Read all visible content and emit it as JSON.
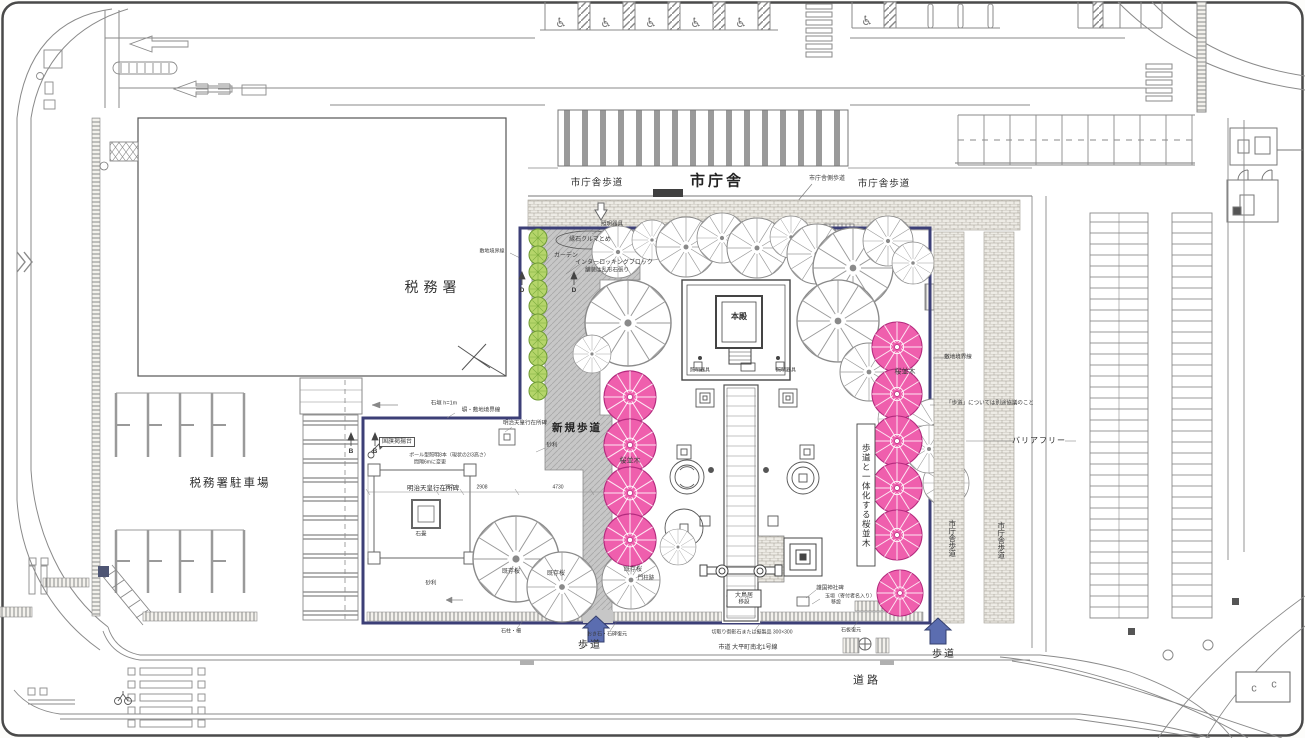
{
  "labels": {
    "city_hall": "市庁舎",
    "city_hall_walk_left": "市庁舎歩道",
    "city_hall_walk_right": "市庁舎歩道",
    "tax_office": "税務署",
    "tax_office_parking": "税務署駐車場",
    "new_walkway": "新規歩道",
    "main_hall": "本殿",
    "meiji_monument": "明治天皇行在所碑",
    "barrier_free": "バリアフリー",
    "cherry_row_integrated": "歩道と一体化する桜並木",
    "sidewalk_left": "歩道",
    "sidewalk_right": "歩道",
    "city_road": "市道 大平町南北1号線",
    "road": "道路"
  },
  "annotations": [
    {
      "t": "市庁舎側歩道",
      "x": 827,
      "y": 179,
      "s": 6
    },
    {
      "t": "照明器具",
      "x": 612,
      "y": 225,
      "s": 5.5
    },
    {
      "t": "縁石クルマとめ",
      "x": 590,
      "y": 240,
      "s": 6
    },
    {
      "t": "ガーデン",
      "x": 566,
      "y": 256,
      "s": 6
    },
    {
      "t": "インターロッキングブロック",
      "x": 614,
      "y": 263,
      "s": 6
    },
    {
      "t": "舗装は乱形石張り",
      "x": 607,
      "y": 271,
      "s": 5.5
    },
    {
      "t": "敷地境界線",
      "x": 492,
      "y": 252,
      "s": 5
    },
    {
      "t": "敷地境界線",
      "x": 958,
      "y": 358,
      "s": 5.5
    },
    {
      "t": "「歩道」については別途協議のこと",
      "x": 990,
      "y": 404,
      "s": 5.5
    },
    {
      "t": "市庁舎歩道",
      "x": 952,
      "y": 538,
      "s": 7.5,
      "v": 1
    },
    {
      "t": "市庁舎歩道",
      "x": 1001,
      "y": 540,
      "s": 7.5,
      "v": 1
    },
    {
      "t": "桜並木",
      "x": 630,
      "y": 461,
      "s": 7
    },
    {
      "t": "桜並木",
      "x": 905,
      "y": 372,
      "s": 7
    },
    {
      "t": "既存桜",
      "x": 511,
      "y": 572,
      "s": 6
    },
    {
      "t": "既存桜",
      "x": 556,
      "y": 574,
      "s": 6
    },
    {
      "t": "既存桜",
      "x": 633,
      "y": 570,
      "s": 6
    },
    {
      "t": "門柱跡",
      "x": 646,
      "y": 579,
      "s": 5.5
    },
    {
      "t": "国旗掲揚台",
      "x": 397,
      "y": 442,
      "s": 6,
      "b": 1
    },
    {
      "t": "ポール型照明8本（現状の2/3高さ）",
      "x": 449,
      "y": 456,
      "s": 5
    },
    {
      "t": "間隔6mに変更",
      "x": 430,
      "y": 463,
      "s": 5
    },
    {
      "t": "石垣 h=1m",
      "x": 444,
      "y": 404,
      "s": 5.5
    },
    {
      "t": "塀・敷地境界線",
      "x": 481,
      "y": 411,
      "s": 5.5
    },
    {
      "t": "明治天皇行在所碑",
      "x": 525,
      "y": 424,
      "s": 5.5
    },
    {
      "t": "石畳",
      "x": 421,
      "y": 535,
      "s": 5.5
    },
    {
      "t": "砂利",
      "x": 552,
      "y": 446,
      "s": 5.5
    },
    {
      "t": "砂利",
      "x": 431,
      "y": 584,
      "s": 5.5
    },
    {
      "t": "757",
      "x": 449,
      "y": 488,
      "s": 5
    },
    {
      "t": "2908",
      "x": 482,
      "y": 488,
      "s": 5
    },
    {
      "t": "4730",
      "x": 558,
      "y": 488,
      "s": 5
    },
    {
      "t": "大鳥居",
      "x": 744,
      "y": 596,
      "s": 6
    },
    {
      "t": "移設",
      "x": 744,
      "y": 603,
      "s": 5.5
    },
    {
      "t": "護国神社碑",
      "x": 830,
      "y": 589,
      "s": 5.5
    },
    {
      "t": "玉垣（寄付者名入り）",
      "x": 850,
      "y": 597,
      "s": 5
    },
    {
      "t": "移設",
      "x": 836,
      "y": 603,
      "s": 5
    },
    {
      "t": "石柱・柵",
      "x": 511,
      "y": 632,
      "s": 5
    },
    {
      "t": "おき石・石碑復元",
      "x": 607,
      "y": 635,
      "s": 5
    },
    {
      "t": "切取り御影石または擬製品 300×300",
      "x": 752,
      "y": 633,
      "s": 5
    },
    {
      "t": "石板復元",
      "x": 851,
      "y": 631,
      "s": 5
    },
    {
      "t": "照明器具",
      "x": 700,
      "y": 371,
      "s": 5
    },
    {
      "t": "照明器具",
      "x": 786,
      "y": 371,
      "s": 5
    },
    {
      "t": "D",
      "x": 522,
      "y": 291,
      "s": 6.5,
      "w": 700
    },
    {
      "t": "D",
      "x": 574,
      "y": 291,
      "s": 6.5,
      "w": 700
    },
    {
      "t": "B",
      "x": 351,
      "y": 452,
      "s": 6.5,
      "w": 700
    },
    {
      "t": "B",
      "x": 375,
      "y": 452,
      "s": 6.5,
      "w": 700
    },
    {
      "t": "c",
      "x": 1254,
      "y": 689,
      "s": 11,
      "c": "#777"
    },
    {
      "t": "c",
      "x": 1274,
      "y": 685,
      "s": 11,
      "c": "#777"
    }
  ],
  "plan": {
    "existing_trees": [
      [
        618,
        252,
        26
      ],
      [
        652,
        240,
        20
      ],
      [
        686,
        247,
        30
      ],
      [
        722,
        238,
        25
      ],
      [
        757,
        248,
        30
      ],
      [
        791,
        237,
        21
      ],
      [
        817,
        254,
        30
      ],
      [
        853,
        268,
        40
      ],
      [
        888,
        241,
        25
      ],
      [
        913,
        263,
        21
      ],
      [
        628,
        323,
        43
      ],
      [
        592,
        354,
        19
      ],
      [
        838,
        321,
        41
      ],
      [
        869,
        372,
        29
      ],
      [
        899,
        419,
        21
      ],
      [
        934,
        426,
        27
      ],
      [
        946,
        483,
        23
      ],
      [
        929,
        449,
        24
      ],
      [
        516,
        559,
        43
      ],
      [
        562,
        587,
        35
      ],
      [
        631,
        580,
        29
      ],
      [
        678,
        547,
        18
      ]
    ],
    "cherry_trees": [
      [
        630,
        397,
        26
      ],
      [
        630,
        445,
        26
      ],
      [
        630,
        493,
        26
      ],
      [
        630,
        540,
        26
      ],
      [
        897,
        347,
        25
      ],
      [
        897,
        394,
        25
      ],
      [
        897,
        441,
        25
      ],
      [
        897,
        488,
        25
      ],
      [
        897,
        535,
        25
      ],
      [
        900,
        593,
        23
      ]
    ],
    "green_plants": [
      [
        538,
        238
      ],
      [
        538,
        255
      ],
      [
        538,
        272
      ],
      [
        538,
        289
      ],
      [
        538,
        306
      ],
      [
        538,
        323
      ],
      [
        538,
        340
      ],
      [
        538,
        357
      ],
      [
        538,
        374
      ],
      [
        538,
        391
      ]
    ],
    "accessible_stalls": [
      [
        561,
        22
      ],
      [
        606,
        22
      ],
      [
        651,
        22
      ],
      [
        696,
        22
      ],
      [
        741,
        22
      ],
      [
        867,
        20
      ]
    ]
  },
  "icons": {
    "wheelchair": "♿"
  },
  "colors": {
    "boundary_navy": "#3c3f77",
    "arrow_blue": "#5b6db0",
    "cherry_pink": "#ef5fad",
    "plant_green": "#b5d56a",
    "paving_gray": "#c7c7c7"
  }
}
